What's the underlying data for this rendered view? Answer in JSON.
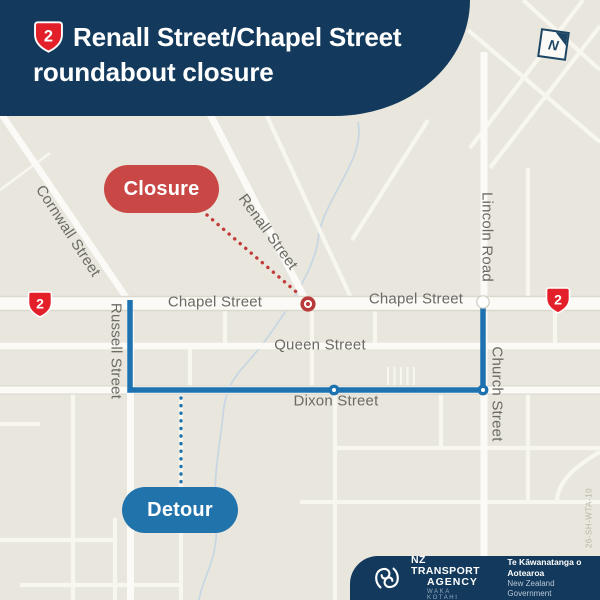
{
  "header": {
    "highway_shield": "2",
    "title_line1": "Renall Street/Chapel Street",
    "title_line2": "roundabout closure"
  },
  "compass": {
    "letter": "N"
  },
  "map": {
    "callouts": {
      "closure": "Closure",
      "detour": "Detour"
    },
    "streets": {
      "cornwall": "Cornwall Street",
      "renall": "Renall Street",
      "chapel_west": "Chapel Street",
      "chapel_east": "Chapel Street",
      "lincoln": "Lincoln Road",
      "russell": "Russell Street",
      "queen": "Queen Street",
      "church": "Church Street",
      "dixon": "Dixon Street"
    },
    "highway_shields": {
      "west": "2",
      "east": "2"
    },
    "reference_code": "26-SH-WTA-10",
    "colors": {
      "navy": "#133A5C",
      "closure_red": "#C94845",
      "marker_red": "#B93A3A",
      "highway_shield_red": "#E3202A",
      "detour_blue": "#1F72B0",
      "map_background": "#E8E6DD",
      "road_white": "#FBFAF7",
      "street_label_gray": "#6B6A64"
    }
  },
  "footer": {
    "agency_line1": "NZ TRANSPORT",
    "agency_line2": "AGENCY",
    "agency_line3": "WAKA KOTAHI",
    "government_line1": "Te Kāwanatanga o Aotearoa",
    "government_line2": "New Zealand Government"
  }
}
